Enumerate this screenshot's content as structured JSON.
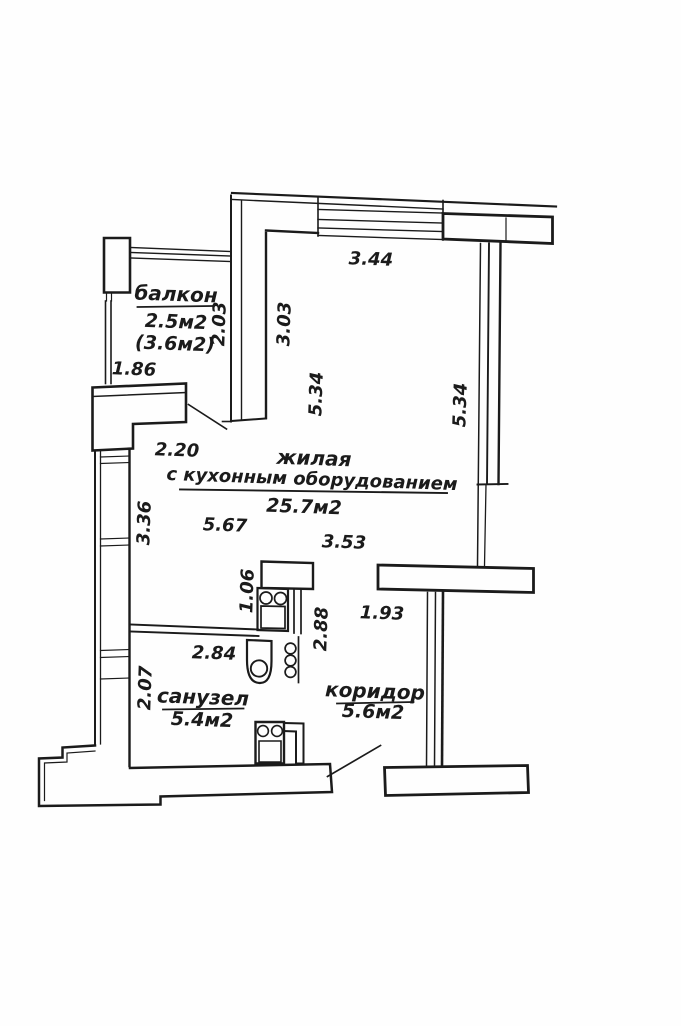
{
  "plan": {
    "type": "apartment floor plan",
    "rooms": [
      {
        "id": "balcony",
        "name": "балкон",
        "area": "2.5м2",
        "area_alt": "(3.6м2)"
      },
      {
        "id": "living",
        "name": "жилая",
        "subtitle": "с кухонным оборудованием",
        "area": "25.7м2"
      },
      {
        "id": "bathroom",
        "name": "санузел",
        "area": "5.4м2"
      },
      {
        "id": "corridor",
        "name": "коридор",
        "area": "5.6м2"
      }
    ],
    "dimensions": {
      "top_window_width": "3.44",
      "balcony_inner_height": "2.03",
      "living_upper_height": "3.03",
      "living_height_left": "5.34",
      "living_height_right": "5.34",
      "balcony_width": "1.86",
      "entry_width": "2.20",
      "living_width": "5.67",
      "living_lower_width": "3.53",
      "living_left_lower_height": "3.36",
      "kitchen_unit_width": "1.06",
      "kitchen_side_height": "2.88",
      "bathroom_width": "2.84",
      "bathroom_height": "2.07",
      "corridor_passage_width": "1.93"
    }
  },
  "colors": {
    "ink": "#1b1b1b",
    "paper": "#fefefe"
  }
}
